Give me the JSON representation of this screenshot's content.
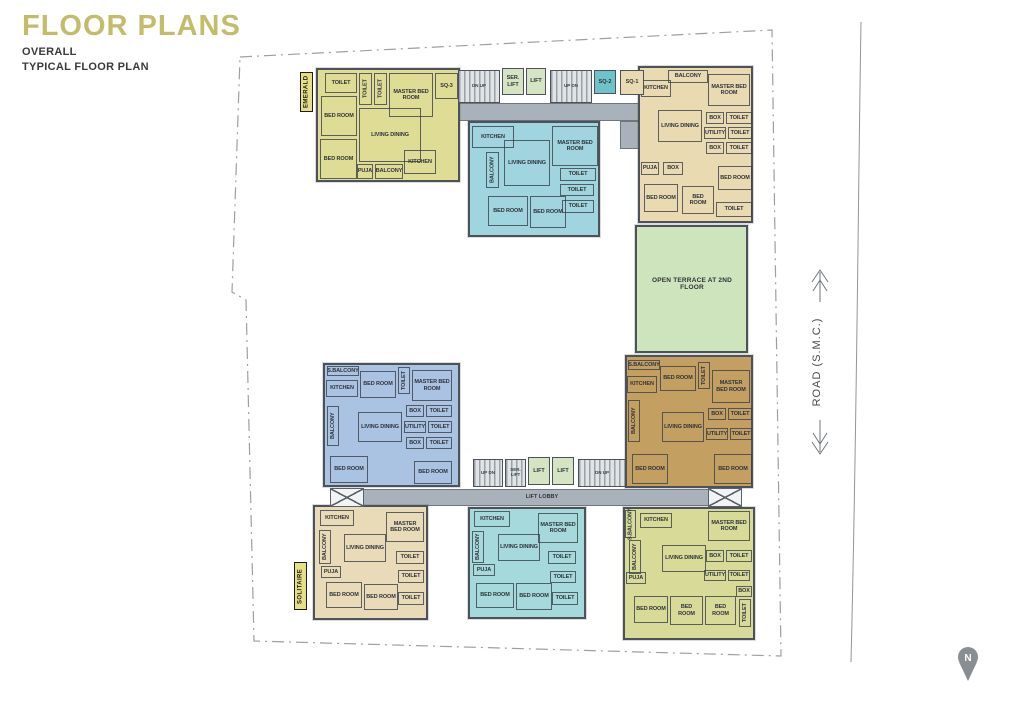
{
  "header": {
    "title": "FLOOR PLANS",
    "line1": "OVERALL",
    "line2": "TYPICAL FLOOR PLAN",
    "title_color": "#c3bd6b"
  },
  "road": {
    "label": "ROAD (S.M.C.)"
  },
  "compass": {
    "label": "N"
  },
  "colors": {
    "wall": "#4d525a",
    "corridor": "#a9b2ba",
    "lift": "#d5e5c3",
    "stair": "#e0e4e6",
    "terrace": "#cde4bc",
    "tag": "#e6df85",
    "boundary_line": "#9aa0a6",
    "road_line": "#8f959b",
    "compass_gray": "#898e93"
  },
  "plan": {
    "units": [
      {
        "id": "emerald",
        "fill": "#dfdc96",
        "x": 316,
        "y": 68,
        "w": 144,
        "h": 114,
        "rooms": [
          {
            "t": "TOILET",
            "x": 325,
            "y": 73,
            "w": 32,
            "h": 20
          },
          {
            "t": "TOILET",
            "x": 359,
            "y": 73,
            "w": 13,
            "h": 32,
            "v": 1
          },
          {
            "t": "TOILET",
            "x": 374,
            "y": 73,
            "w": 13,
            "h": 32,
            "v": 1
          },
          {
            "t": "MASTER BED ROOM",
            "x": 389,
            "y": 73,
            "w": 44,
            "h": 44
          },
          {
            "t": "SQ-3",
            "x": 435,
            "y": 73,
            "w": 23,
            "h": 26
          },
          {
            "t": "BED ROOM",
            "x": 321,
            "y": 96,
            "w": 36,
            "h": 40
          },
          {
            "t": "LIVING DINING",
            "x": 359,
            "y": 108,
            "w": 62,
            "h": 54
          },
          {
            "t": "BED ROOM",
            "x": 320,
            "y": 139,
            "w": 37,
            "h": 40
          },
          {
            "t": "PUJA",
            "x": 357,
            "y": 164,
            "w": 16,
            "h": 15
          },
          {
            "t": "BALCONY",
            "x": 375,
            "y": 164,
            "w": 28,
            "h": 15
          },
          {
            "t": "KITCHEN",
            "x": 404,
            "y": 150,
            "w": 32,
            "h": 24
          }
        ]
      },
      {
        "id": "top-middle",
        "fill": "#a0d4df",
        "x": 468,
        "y": 121,
        "w": 132,
        "h": 116,
        "rooms": [
          {
            "t": "KITCHEN",
            "x": 472,
            "y": 126,
            "w": 42,
            "h": 22
          },
          {
            "t": "MASTER BED ROOM",
            "x": 552,
            "y": 126,
            "w": 46,
            "h": 40
          },
          {
            "t": "LIVING DINING",
            "x": 504,
            "y": 140,
            "w": 46,
            "h": 46
          },
          {
            "t": "BALCONY",
            "x": 486,
            "y": 152,
            "w": 13,
            "h": 36,
            "v": 1
          },
          {
            "t": "TOILET",
            "x": 560,
            "y": 168,
            "w": 36,
            "h": 13
          },
          {
            "t": "TOILET",
            "x": 560,
            "y": 184,
            "w": 34,
            "h": 12
          },
          {
            "t": "BED ROOM",
            "x": 488,
            "y": 196,
            "w": 40,
            "h": 30
          },
          {
            "t": "BED ROOM",
            "x": 530,
            "y": 196,
            "w": 36,
            "h": 32
          },
          {
            "t": "TOILET",
            "x": 562,
            "y": 200,
            "w": 32,
            "h": 13
          }
        ]
      },
      {
        "id": "top-right",
        "fill": "#e9dab2",
        "x": 638,
        "y": 66,
        "w": 115,
        "h": 157,
        "rooms": [
          {
            "t": "BALCONY",
            "x": 668,
            "y": 70,
            "w": 40,
            "h": 13
          },
          {
            "t": "KITCHEN",
            "x": 641,
            "y": 80,
            "w": 30,
            "h": 17
          },
          {
            "t": "MASTER BED ROOM",
            "x": 708,
            "y": 74,
            "w": 42,
            "h": 32
          },
          {
            "t": "LIVING DINING",
            "x": 658,
            "y": 110,
            "w": 44,
            "h": 32
          },
          {
            "t": "BOX",
            "x": 706,
            "y": 112,
            "w": 18,
            "h": 12
          },
          {
            "t": "TOILET",
            "x": 726,
            "y": 112,
            "w": 26,
            "h": 12
          },
          {
            "t": "UTILITY",
            "x": 704,
            "y": 127,
            "w": 22,
            "h": 12
          },
          {
            "t": "TOILET",
            "x": 728,
            "y": 127,
            "w": 24,
            "h": 12
          },
          {
            "t": "BOX",
            "x": 706,
            "y": 142,
            "w": 18,
            "h": 12
          },
          {
            "t": "TOILET",
            "x": 726,
            "y": 142,
            "w": 26,
            "h": 12
          },
          {
            "t": "PUJA",
            "x": 641,
            "y": 162,
            "w": 18,
            "h": 13
          },
          {
            "t": "BOX",
            "x": 663,
            "y": 162,
            "w": 20,
            "h": 13
          },
          {
            "t": "BED ROOM",
            "x": 718,
            "y": 166,
            "w": 34,
            "h": 24
          },
          {
            "t": "BED ROOM",
            "x": 644,
            "y": 184,
            "w": 34,
            "h": 28
          },
          {
            "t": "BED ROOM",
            "x": 682,
            "y": 186,
            "w": 32,
            "h": 28
          },
          {
            "t": "TOILET",
            "x": 716,
            "y": 202,
            "w": 36,
            "h": 15
          }
        ]
      },
      {
        "id": "terrace",
        "fill": "#cde4bc",
        "x": 635,
        "y": 225,
        "w": 113,
        "h": 128,
        "rooms": [
          {
            "t": "OPEN TERRACE AT 2ND FLOOR",
            "x": 648,
            "y": 268,
            "w": 88,
            "h": 32,
            "plain": 1
          }
        ]
      },
      {
        "id": "mid-left-blue",
        "fill": "#aac3e2",
        "x": 323,
        "y": 363,
        "w": 137,
        "h": 124,
        "rooms": [
          {
            "t": "S.BALCONY",
            "x": 327,
            "y": 366,
            "w": 32,
            "h": 10
          },
          {
            "t": "KITCHEN",
            "x": 326,
            "y": 380,
            "w": 32,
            "h": 17
          },
          {
            "t": "BED ROOM",
            "x": 360,
            "y": 371,
            "w": 36,
            "h": 27
          },
          {
            "t": "TOILET",
            "x": 398,
            "y": 367,
            "w": 12,
            "h": 27,
            "v": 1
          },
          {
            "t": "MASTER BED ROOM",
            "x": 412,
            "y": 370,
            "w": 40,
            "h": 31
          },
          {
            "t": "BALCONY",
            "x": 327,
            "y": 406,
            "w": 12,
            "h": 40,
            "v": 1
          },
          {
            "t": "LIVING DINING",
            "x": 358,
            "y": 412,
            "w": 44,
            "h": 30
          },
          {
            "t": "BOX",
            "x": 406,
            "y": 405,
            "w": 18,
            "h": 12
          },
          {
            "t": "TOILET",
            "x": 426,
            "y": 405,
            "w": 26,
            "h": 12
          },
          {
            "t": "UTILITY",
            "x": 404,
            "y": 421,
            "w": 22,
            "h": 12
          },
          {
            "t": "TOILET",
            "x": 428,
            "y": 421,
            "w": 24,
            "h": 12
          },
          {
            "t": "BOX",
            "x": 406,
            "y": 437,
            "w": 18,
            "h": 12
          },
          {
            "t": "TOILET",
            "x": 426,
            "y": 437,
            "w": 26,
            "h": 12
          },
          {
            "t": "BED ROOM",
            "x": 330,
            "y": 456,
            "w": 38,
            "h": 27
          },
          {
            "t": "BED ROOM",
            "x": 414,
            "y": 461,
            "w": 38,
            "h": 23
          }
        ]
      },
      {
        "id": "mid-right-brown",
        "fill": "#c49f62",
        "x": 625,
        "y": 355,
        "w": 128,
        "h": 133,
        "rooms": [
          {
            "t": "S.BALCONY",
            "x": 628,
            "y": 360,
            "w": 32,
            "h": 10
          },
          {
            "t": "KITCHEN",
            "x": 627,
            "y": 376,
            "w": 30,
            "h": 17
          },
          {
            "t": "BED ROOM",
            "x": 660,
            "y": 366,
            "w": 36,
            "h": 25
          },
          {
            "t": "TOILET",
            "x": 698,
            "y": 362,
            "w": 12,
            "h": 27,
            "v": 1
          },
          {
            "t": "MASTER BED ROOM",
            "x": 712,
            "y": 370,
            "w": 38,
            "h": 33
          },
          {
            "t": "BALCONY",
            "x": 628,
            "y": 400,
            "w": 12,
            "h": 42,
            "v": 1
          },
          {
            "t": "LIVING DINING",
            "x": 662,
            "y": 412,
            "w": 42,
            "h": 30
          },
          {
            "t": "BOX",
            "x": 708,
            "y": 408,
            "w": 18,
            "h": 12
          },
          {
            "t": "TOILET",
            "x": 728,
            "y": 408,
            "w": 24,
            "h": 12
          },
          {
            "t": "UTILITY",
            "x": 706,
            "y": 428,
            "w": 22,
            "h": 12
          },
          {
            "t": "TOILET",
            "x": 730,
            "y": 428,
            "w": 22,
            "h": 12
          },
          {
            "t": "BED ROOM",
            "x": 632,
            "y": 454,
            "w": 36,
            "h": 30
          },
          {
            "t": "BED ROOM",
            "x": 714,
            "y": 454,
            "w": 38,
            "h": 30
          }
        ]
      },
      {
        "id": "bottom-left",
        "fill": "#e9dbb8",
        "x": 313,
        "y": 505,
        "w": 115,
        "h": 115,
        "rooms": [
          {
            "t": "KITCHEN",
            "x": 320,
            "y": 510,
            "w": 34,
            "h": 16
          },
          {
            "t": "MASTER BED ROOM",
            "x": 386,
            "y": 512,
            "w": 38,
            "h": 30
          },
          {
            "t": "BALCONY",
            "x": 319,
            "y": 530,
            "w": 12,
            "h": 34,
            "v": 1
          },
          {
            "t": "LIVING DINING",
            "x": 344,
            "y": 534,
            "w": 42,
            "h": 28
          },
          {
            "t": "TOILET",
            "x": 396,
            "y": 551,
            "w": 28,
            "h": 13
          },
          {
            "t": "PUJA",
            "x": 321,
            "y": 566,
            "w": 20,
            "h": 12
          },
          {
            "t": "TOILET",
            "x": 398,
            "y": 570,
            "w": 26,
            "h": 13
          },
          {
            "t": "BED ROOM",
            "x": 326,
            "y": 582,
            "w": 36,
            "h": 26
          },
          {
            "t": "BED ROOM",
            "x": 364,
            "y": 584,
            "w": 34,
            "h": 26
          },
          {
            "t": "TOILET",
            "x": 398,
            "y": 592,
            "w": 26,
            "h": 13
          }
        ]
      },
      {
        "id": "bottom-middle",
        "fill": "#a6d9db",
        "x": 468,
        "y": 507,
        "w": 118,
        "h": 112,
        "rooms": [
          {
            "t": "KITCHEN",
            "x": 474,
            "y": 511,
            "w": 36,
            "h": 16
          },
          {
            "t": "MASTER BED ROOM",
            "x": 538,
            "y": 513,
            "w": 40,
            "h": 30
          },
          {
            "t": "BALCONY",
            "x": 472,
            "y": 531,
            "w": 12,
            "h": 32,
            "v": 1
          },
          {
            "t": "LIVING DINING",
            "x": 498,
            "y": 534,
            "w": 42,
            "h": 27
          },
          {
            "t": "TOILET",
            "x": 548,
            "y": 551,
            "w": 28,
            "h": 13
          },
          {
            "t": "PUJA",
            "x": 473,
            "y": 564,
            "w": 22,
            "h": 12
          },
          {
            "t": "TOILET",
            "x": 550,
            "y": 571,
            "w": 26,
            "h": 12
          },
          {
            "t": "BED ROOM",
            "x": 476,
            "y": 583,
            "w": 38,
            "h": 25
          },
          {
            "t": "BED ROOM",
            "x": 516,
            "y": 583,
            "w": 36,
            "h": 27
          },
          {
            "t": "TOILET",
            "x": 552,
            "y": 592,
            "w": 26,
            "h": 13
          }
        ]
      },
      {
        "id": "bottom-right",
        "fill": "#d7db97",
        "x": 623,
        "y": 507,
        "w": 132,
        "h": 133,
        "rooms": [
          {
            "t": "S.BALCONY",
            "x": 625,
            "y": 510,
            "w": 11,
            "h": 28,
            "v": 1
          },
          {
            "t": "KITCHEN",
            "x": 640,
            "y": 513,
            "w": 32,
            "h": 15
          },
          {
            "t": "MASTER BED ROOM",
            "x": 708,
            "y": 511,
            "w": 42,
            "h": 30
          },
          {
            "t": "BALCONY",
            "x": 629,
            "y": 540,
            "w": 12,
            "h": 34,
            "v": 1
          },
          {
            "t": "LIVING DINING",
            "x": 662,
            "y": 545,
            "w": 44,
            "h": 27
          },
          {
            "t": "BOX",
            "x": 706,
            "y": 550,
            "w": 18,
            "h": 12
          },
          {
            "t": "TOILET",
            "x": 726,
            "y": 550,
            "w": 26,
            "h": 12
          },
          {
            "t": "UTILITY",
            "x": 704,
            "y": 570,
            "w": 22,
            "h": 11
          },
          {
            "t": "TOILET",
            "x": 728,
            "y": 570,
            "w": 22,
            "h": 11
          },
          {
            "t": "PUJA",
            "x": 626,
            "y": 572,
            "w": 20,
            "h": 12
          },
          {
            "t": "BED ROOM",
            "x": 634,
            "y": 596,
            "w": 34,
            "h": 27
          },
          {
            "t": "BED ROOM",
            "x": 670,
            "y": 596,
            "w": 33,
            "h": 29
          },
          {
            "t": "BED ROOM",
            "x": 705,
            "y": 596,
            "w": 31,
            "h": 29
          },
          {
            "t": "BOX",
            "x": 736,
            "y": 586,
            "w": 16,
            "h": 11
          },
          {
            "t": "TOILET",
            "x": 739,
            "y": 599,
            "w": 12,
            "h": 28,
            "v": 1
          }
        ]
      }
    ],
    "corridors": [
      {
        "x": 436,
        "y": 103,
        "w": 212,
        "h": 18
      },
      {
        "x": 620,
        "y": 121,
        "w": 22,
        "h": 28
      },
      {
        "x": 330,
        "y": 489,
        "w": 412,
        "h": 17
      }
    ],
    "cells": [
      {
        "t": "DN UP",
        "x": 458,
        "y": 70,
        "w": 42,
        "h": 33,
        "kind": "stair"
      },
      {
        "t": "SER. LIFT",
        "x": 502,
        "y": 68,
        "w": 22,
        "h": 27,
        "kind": "lift"
      },
      {
        "t": "LIFT",
        "x": 526,
        "y": 68,
        "w": 20,
        "h": 27,
        "kind": "lift"
      },
      {
        "t": "UP DN",
        "x": 550,
        "y": 70,
        "w": 42,
        "h": 33,
        "kind": "stair"
      },
      {
        "t": "SQ-2",
        "x": 594,
        "y": 70,
        "w": 22,
        "h": 24,
        "fill": "#6fc2ca"
      },
      {
        "t": "SQ-1",
        "x": 620,
        "y": 70,
        "w": 24,
        "h": 25,
        "fill": "#e9dab2"
      },
      {
        "t": "UP DN",
        "x": 473,
        "y": 459,
        "w": 30,
        "h": 28,
        "kind": "stair"
      },
      {
        "t": "SER. LIFT",
        "x": 505,
        "y": 459,
        "w": 21,
        "h": 28,
        "kind": "stair"
      },
      {
        "t": "LIFT",
        "x": 528,
        "y": 457,
        "w": 22,
        "h": 28,
        "kind": "lift"
      },
      {
        "t": "LIFT",
        "x": 552,
        "y": 457,
        "w": 22,
        "h": 28,
        "kind": "lift"
      },
      {
        "t": "DN UP",
        "x": 578,
        "y": 459,
        "w": 48,
        "h": 28,
        "kind": "stair"
      },
      {
        "t": "LIFT LOBBY",
        "x": 514,
        "y": 488,
        "w": 56,
        "h": 18,
        "kind": "lobby"
      }
    ],
    "xboxes": [
      {
        "x": 330,
        "y": 488,
        "w": 34,
        "h": 19
      },
      {
        "x": 708,
        "y": 488,
        "w": 34,
        "h": 19
      }
    ],
    "tags": [
      {
        "t": "EMERALD",
        "x": 300,
        "y": 72,
        "w": 13,
        "h": 40
      },
      {
        "t": "SOLITAIRE",
        "x": 294,
        "y": 562,
        "w": 13,
        "h": 48
      }
    ]
  }
}
